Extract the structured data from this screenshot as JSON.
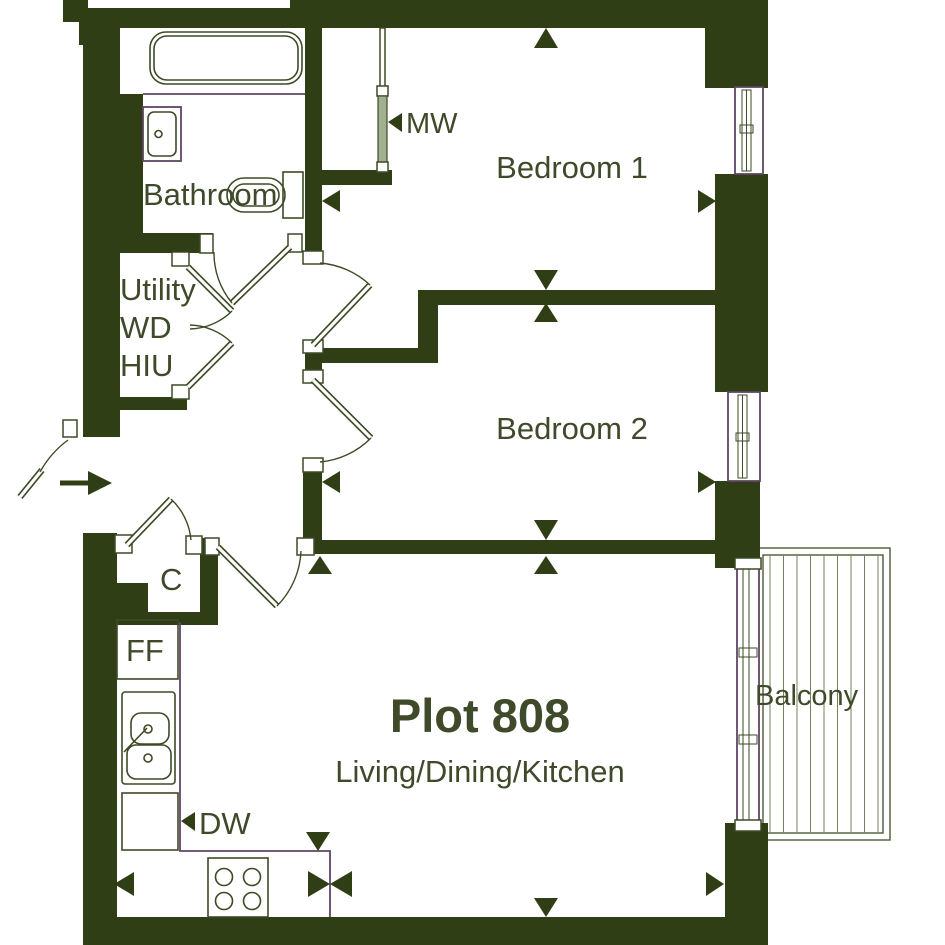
{
  "title": "Plot 808 floor plan",
  "colors": {
    "wall": "#2f3e15",
    "line": "#3d4a26",
    "accent_purple": "#5e4565",
    "text": "#3f4a2a",
    "partition_fill": "#a3af91",
    "background": "#ffffff"
  },
  "labels": {
    "plot": "Plot 808",
    "living": "Living/Dining/Kitchen",
    "bedroom1": "Bedroom 1",
    "bedroom2": "Bedroom 2",
    "bathroom": "Bathroom",
    "balcony": "Balcony",
    "utility_line1": "Utility",
    "utility_line2": "WD",
    "utility_line3": "HIU",
    "cupboard": "C",
    "fridge_freezer": "FF",
    "dishwasher": "DW",
    "microwave": "MW"
  }
}
